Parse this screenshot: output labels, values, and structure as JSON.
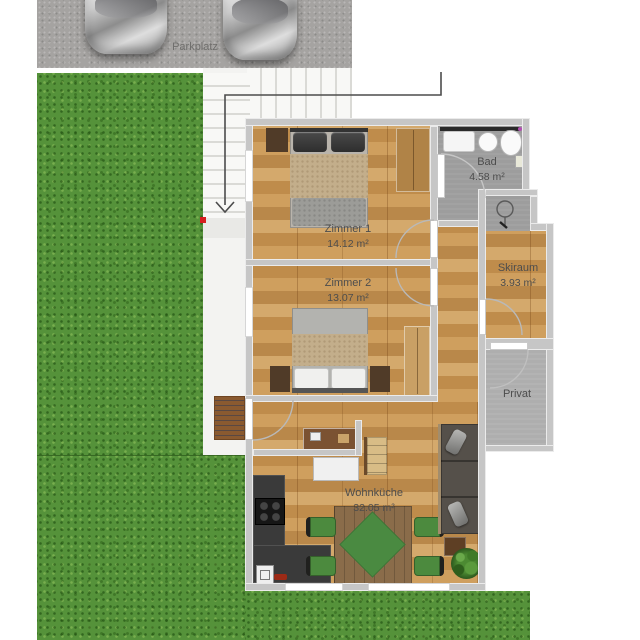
{
  "site": {
    "parking_label": "Parkplatz"
  },
  "rooms": {
    "zimmer1": {
      "name": "Zimmer 1",
      "area": "14.12 m²"
    },
    "zimmer2": {
      "name": "Zimmer 2",
      "area": "13.07 m²"
    },
    "bad": {
      "name": "Bad",
      "area": "4.58 m²"
    },
    "skiraum": {
      "name": "Skiraum",
      "area": "3.93 m²"
    },
    "privat": {
      "name": "Privat"
    },
    "wohnkueche": {
      "name": "Wohnküche",
      "area": "32.05 m²"
    }
  },
  "icons": {
    "stair_direction": "down-arrow",
    "coat_stand": "coat-stand",
    "entry_marker": "red-square"
  },
  "colors": {
    "grass": "#55923a",
    "asphalt": "#a5a3a1",
    "wood_floor": "#c79756",
    "wall": "#c6c6c6",
    "bath_floor": "#9d9d9d",
    "label_text": "#4d4d4d",
    "entry_marker": "#d61f1f",
    "table_cloth": "#4a8a41"
  }
}
